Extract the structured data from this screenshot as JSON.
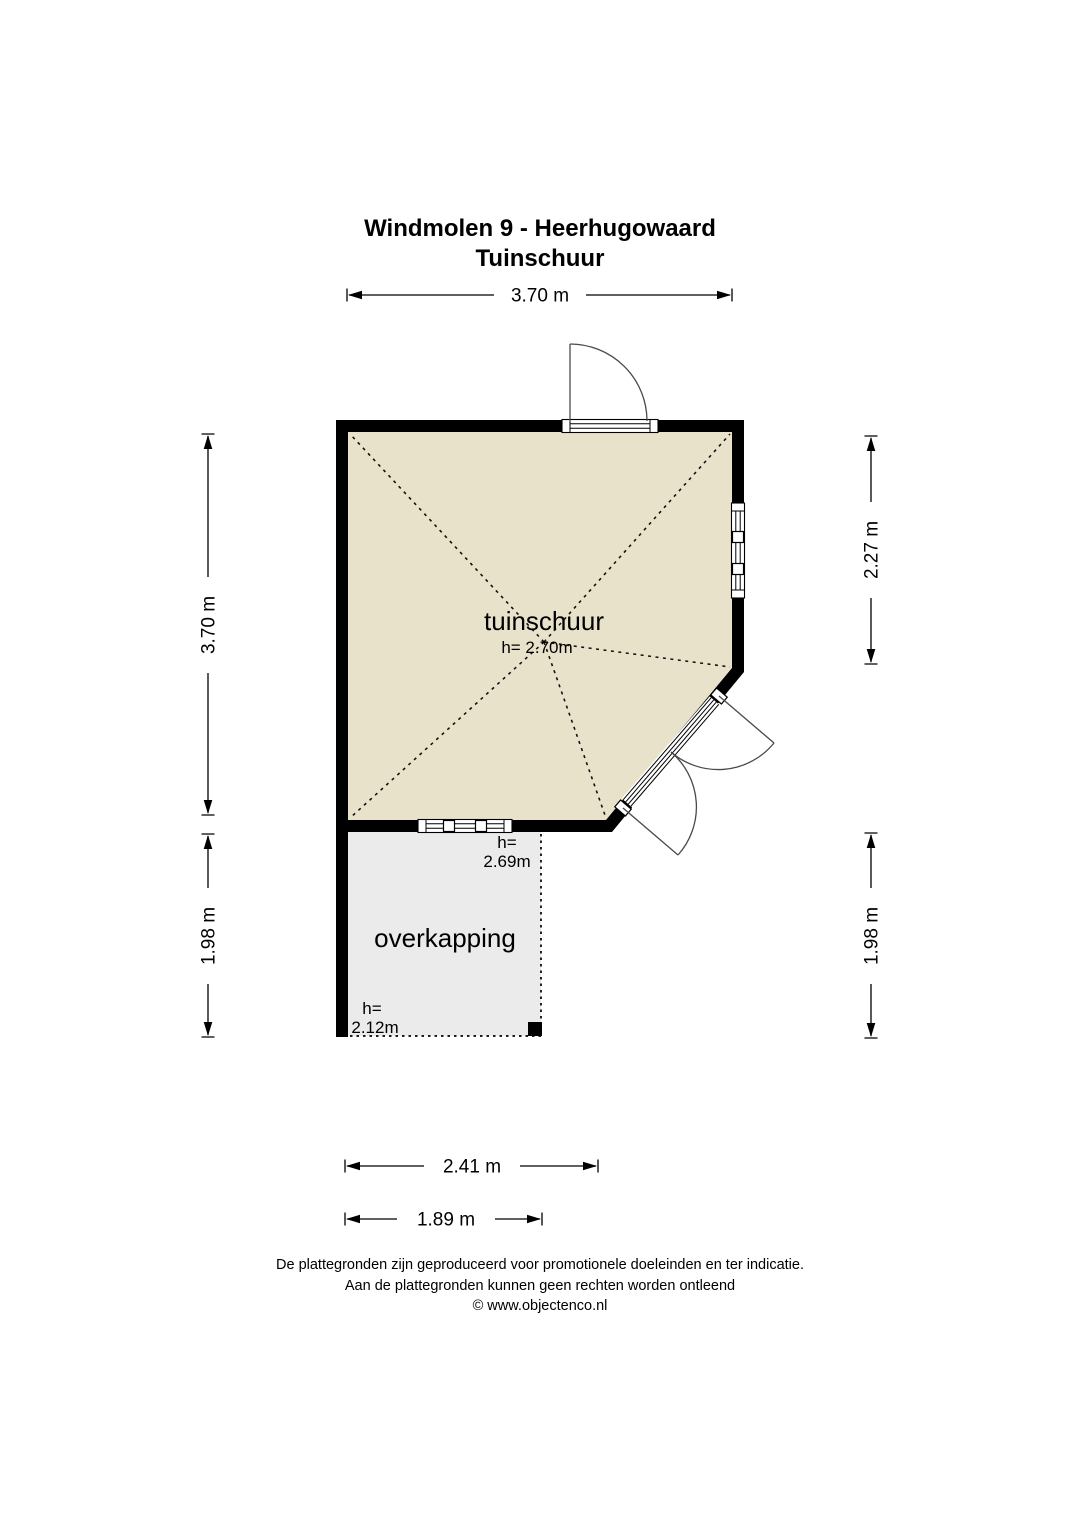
{
  "title": {
    "line1": "Windmolen 9 - Heerhugowaard",
    "line2": "Tuinschuur"
  },
  "dimensions": {
    "top_width": "3.70 m",
    "left_total_height": "3.70 m",
    "left_overkapping_height": "1.98 m",
    "right_wall_height": "2.27 m",
    "right_overkapping_height": "1.98 m",
    "bottom_overkapping_width": "2.41 m",
    "bottom_overkapping_inner_width": "1.89 m"
  },
  "rooms": {
    "tuinschuur": {
      "label": "tuinschuur",
      "ceiling_height": "h= 2.70m"
    },
    "overkapping": {
      "label": "overkapping",
      "height_at_wall_line1": "h=",
      "height_at_wall_line2": "2.69m",
      "height_at_edge_line1": "h=",
      "height_at_edge_line2": "2.12m"
    }
  },
  "footer": {
    "line1": "De plattegronden zijn geproduceerd voor promotionele doeleinden en ter indicatie.",
    "line2": "Aan de plattegronden kunnen geen rechten worden ontleend",
    "line3": "© www.objectenco.nl"
  },
  "colors": {
    "room_fill": "#e9e2cb",
    "overkapping_fill": "#ebebeb",
    "wall": "#000000",
    "door_line": "#4a4a4a"
  }
}
